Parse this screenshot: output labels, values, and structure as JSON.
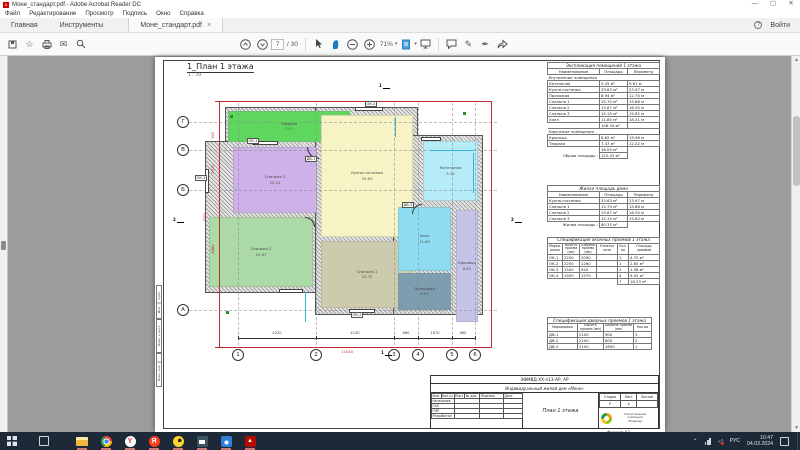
{
  "titlebar": {
    "title": "Моне_стандарт.pdf - Adobe Acrobat Reader DC"
  },
  "menubar": [
    "Файл",
    "Редактирование",
    "Просмотр",
    "Подпись",
    "Окно",
    "Справка"
  ],
  "tabbar": {
    "home": "Главная",
    "tools": "Инструменты",
    "document": "Моне_стандарт.pdf",
    "close": "×",
    "help": "?",
    "signin": "Войти"
  },
  "toolbar": {
    "page": "7",
    "pages": "/ 30",
    "zoom": "71%"
  },
  "page_left_frame": [
    "Инв. № подл.",
    "Подп. и дата",
    "Взам. инв. №"
  ],
  "drawing": {
    "title": "1_План 1 этажа",
    "scale": "1 : 70",
    "grid_rows": [
      "Г",
      "В",
      "Б",
      "А"
    ],
    "grid_cols": [
      "1",
      "2",
      "3",
      "4",
      "5",
      "6"
    ],
    "rooms": [
      {
        "id": "terrasa",
        "name": "Терраса",
        "area": "7.47",
        "color": "#5fd75f",
        "x": 73,
        "y": 54,
        "w": 122,
        "h": 31
      },
      {
        "id": "spalnya3",
        "name": "Спальня 3",
        "area": "15.15",
        "color": "#cdb1e8",
        "x": 78,
        "y": 90,
        "w": 84,
        "h": 66
      },
      {
        "id": "spalnya2",
        "name": "Спальня 2",
        "area": "15.87",
        "color": "#abdaa6",
        "x": 54,
        "y": 160,
        "w": 104,
        "h": 70
      },
      {
        "id": "kuhnya",
        "name": "Кухня-гостиная",
        "area": "33.63",
        "color": "#f8f3c5",
        "x": 166,
        "y": 58,
        "w": 92,
        "h": 122
      },
      {
        "id": "spalnya1",
        "name": "Спальня 1",
        "area": "15.70",
        "color": "#cdcbae",
        "x": 166,
        "y": 184,
        "w": 92,
        "h": 67
      },
      {
        "id": "kotelnaya",
        "name": "Котельная",
        "area": "5.25",
        "color": "#b5ecf7",
        "x": 268,
        "y": 84,
        "w": 55,
        "h": 60
      },
      {
        "id": "holl",
        "name": "Холл",
        "area": "11.80",
        "color": "#8edcf0",
        "x": 243,
        "y": 150,
        "w": 53,
        "h": 64
      },
      {
        "id": "prihozhaya",
        "name": "Прихожая",
        "area": "8.94",
        "color": "#7e9dae",
        "x": 243,
        "y": 216,
        "w": 53,
        "h": 37
      },
      {
        "id": "kryltso",
        "name": "Крыльцо",
        "area": "8.62",
        "color": "#c6c3e8",
        "x": 301,
        "y": 153,
        "w": 22,
        "h": 112
      }
    ],
    "openings": [
      {
        "label": "ОК-1",
        "x": 92,
        "y": 81
      },
      {
        "label": "ОК-2",
        "x": 210,
        "y": 44
      },
      {
        "label": "ОК-2",
        "x": 196,
        "y": 255
      },
      {
        "label": "ОК-3",
        "x": 40,
        "y": 118
      },
      {
        "label": "ДВ-1",
        "x": 150,
        "y": 99
      },
      {
        "label": "ДВ-3",
        "x": 247,
        "y": 145
      }
    ],
    "dims_bottom": [
      "4220",
      "4130",
      "660",
      "1870",
      "660"
    ],
    "dims_left": [
      "500",
      "2520",
      "4480"
    ],
    "dim_total_bottom": "11540",
    "dim_total_left": "7500"
  },
  "tables": {
    "explication": {
      "title": "Экспликация помещений 1 этажа",
      "headers": [
        "Наименование",
        "Площадь",
        "Периметр"
      ],
      "section1": "Внутренние помещения",
      "rows1": [
        [
          "Котельная",
          "5.25 м²",
          "9.61 м"
        ],
        [
          "Кухня-гостиная",
          "33.63 м²",
          "23.97 м"
        ],
        [
          "Прихожая",
          "8.94 м²",
          "12.70 м"
        ],
        [
          "Спальня 1",
          "15.70 м²",
          "15.86 м"
        ],
        [
          "Спальня 2",
          "15.87 м²",
          "16.30 м"
        ],
        [
          "Спальня 3",
          "15.15 м²",
          "15.62 м"
        ],
        [
          "Холл",
          "11.80 м²",
          "18.31 м"
        ]
      ],
      "subtotal1": "106.34 м²",
      "section2": "Наружные помещения",
      "rows2": [
        [
          "Крыльцо",
          "8.62 м²",
          "15.98 м"
        ],
        [
          "Терраса",
          "7.47 м²",
          "12.22 м"
        ]
      ],
      "subtotal2": "16.09 м²",
      "total_label": "Общая площадь :",
      "total": "122.43 м²"
    },
    "living": {
      "title": "Жилая площадь дома",
      "headers": [
        "Наименование",
        "Площадь",
        "Периметр"
      ],
      "rows": [
        [
          "Кухня-гостиная",
          "33.63 м²",
          "23.97 м"
        ],
        [
          "Спальня 1",
          "15.70 м²",
          "15.86 м"
        ],
        [
          "Спальня 2",
          "15.87 м²",
          "16.30 м"
        ],
        [
          "Спальня 3",
          "15.15 м²",
          "15.62 м"
        ]
      ],
      "total_label": "Жилая площадь :",
      "total": "80.35 м²"
    },
    "windows": {
      "title": "Спецификация оконных проемов 1 этажа",
      "headers": [
        "Марки- ровка",
        "Высота проема (мм)",
        "Ширина проема (мм)",
        "Отметка низа",
        "Кол- во",
        "Площадь проемов"
      ],
      "rows": [
        [
          "ОК-1",
          "2250",
          "2090",
          "",
          "1",
          "4.70 м²"
        ],
        [
          "ОК-2",
          "2250",
          "1260",
          "",
          "1",
          "2.83 м²"
        ],
        [
          "ОК-3",
          "1500",
          "920",
          "",
          "1",
          "1.38 м²"
        ],
        [
          "ОК-4",
          "1500",
          "1570",
          "",
          "4",
          "9.42 м²"
        ]
      ],
      "total_count": "7",
      "total_area": "18.33 м²"
    },
    "doors": {
      "title": "Спецификация дверных проемов 1 этажа",
      "headers": [
        "Маркировка",
        "Высота проема (мм)",
        "Ширина проема (мм)",
        "Кол-во"
      ],
      "rows": [
        [
          "ДВ-1",
          "2100",
          "900",
          "3"
        ],
        [
          "ДВ-2",
          "2100",
          "800",
          "2"
        ],
        [
          "ДВ-3",
          "2100",
          "1800",
          "1"
        ]
      ]
    }
  },
  "stamp": {
    "code": "ЭФМВД-ХХ-п13-АР, АР",
    "object": "Индивидуальный жилой дом «Моне»",
    "cols": [
      "Изм.",
      "Кол.уч",
      "Лист",
      "№ док.",
      "Подпись",
      "Дата"
    ],
    "roles": [
      "Начальник",
      "ГАП",
      "ГИП",
      "Разработал"
    ],
    "sheet_title": "План 1 этажа",
    "stage_headers": [
      "Стадия",
      "Лист",
      "Листов"
    ],
    "stage": "Р",
    "sheet": "4",
    "sheets": "",
    "company": [
      "Строительная",
      "компания",
      "«Подряд»"
    ],
    "format": "Формат А3"
  },
  "taskbar": {
    "tray": {
      "lang": "РУС",
      "time": "10:47",
      "date": "04.03.2024"
    }
  }
}
